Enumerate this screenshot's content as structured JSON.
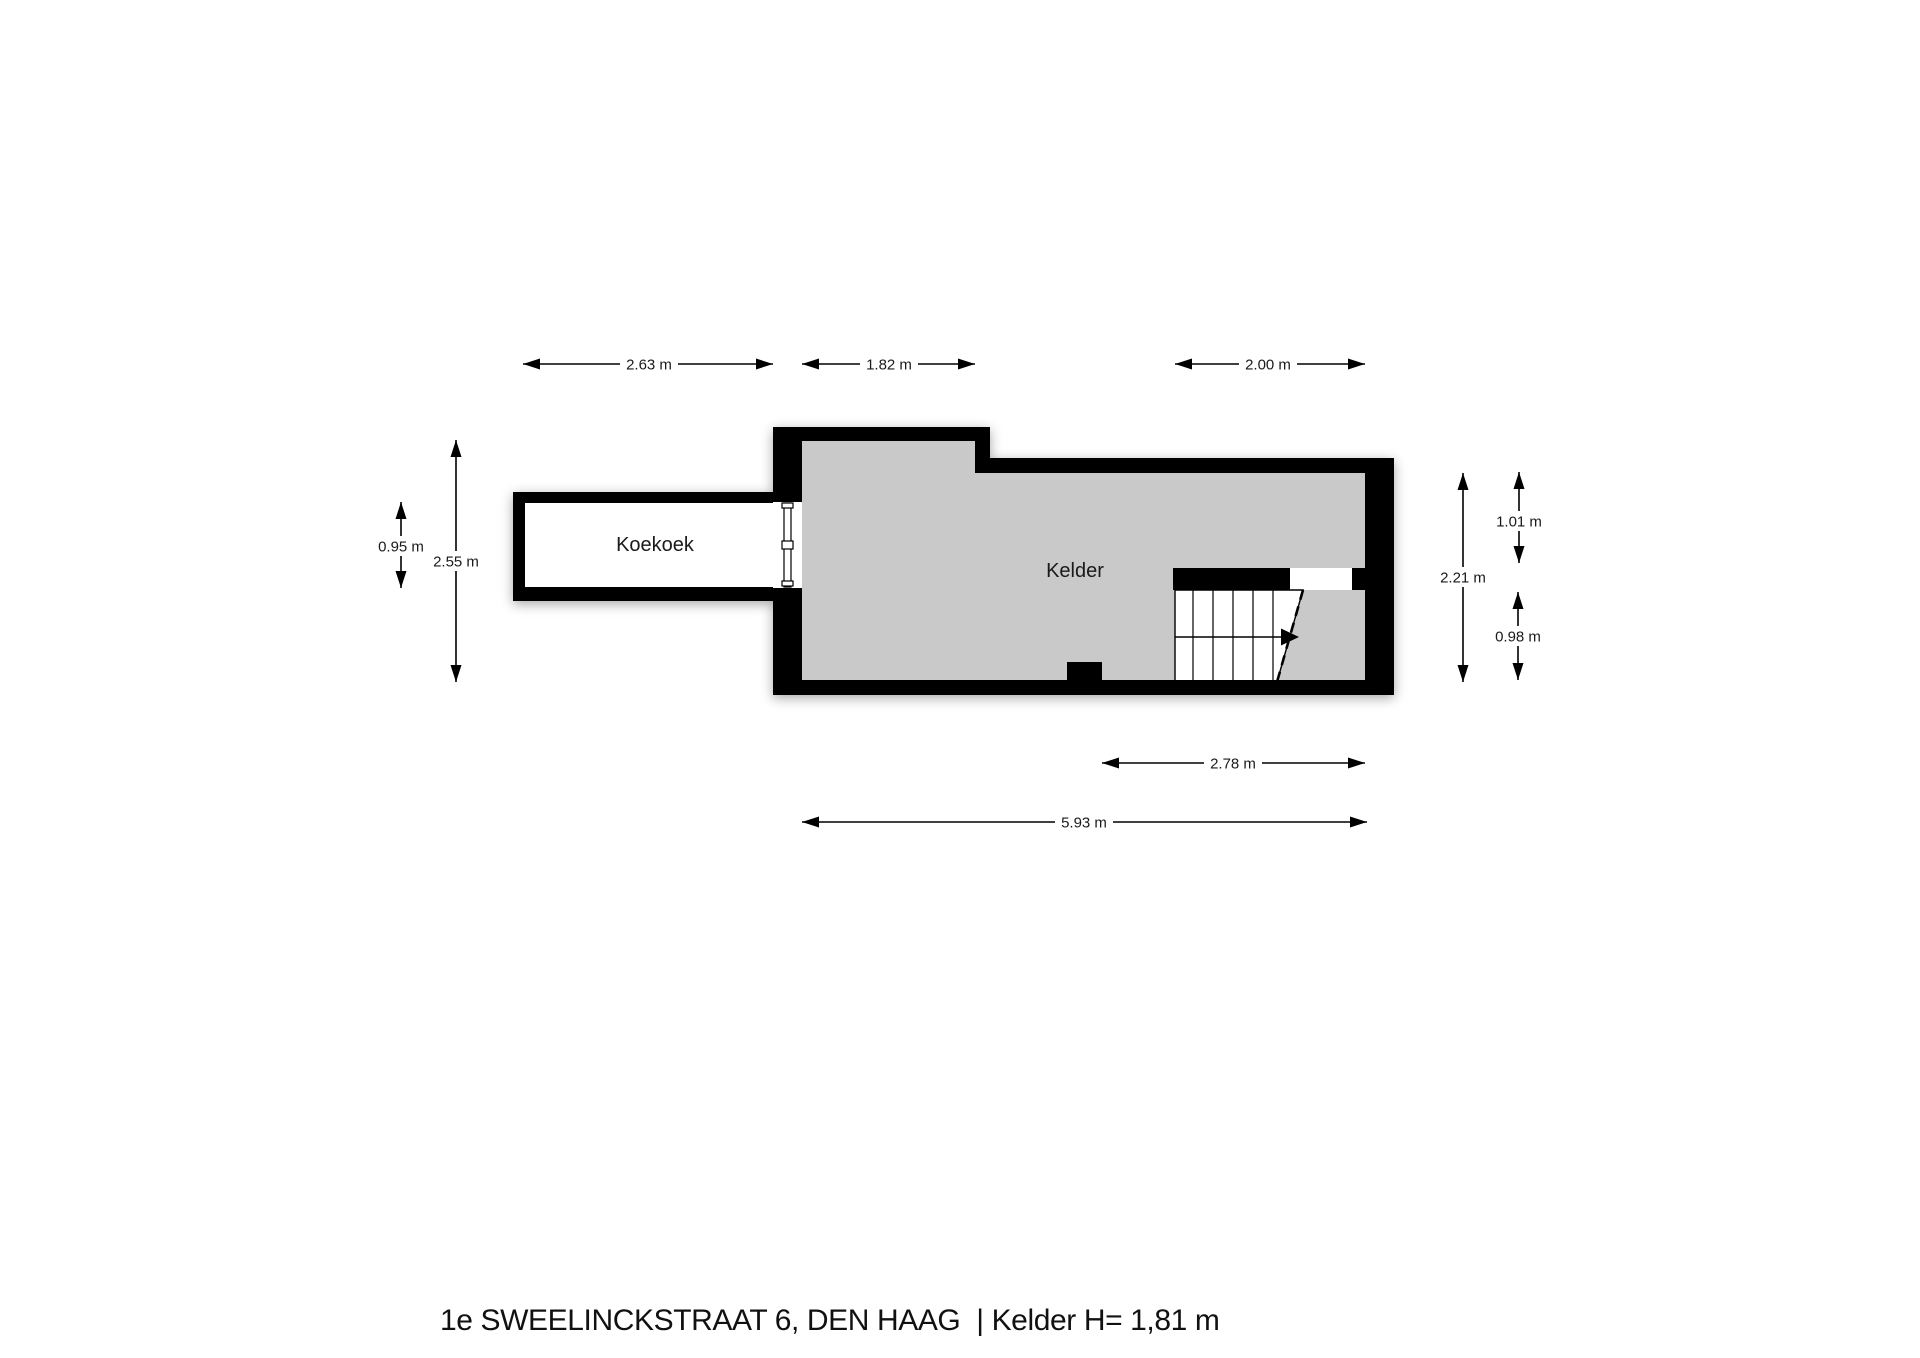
{
  "page": {
    "title": "1e SWEELINCKSTRAAT 6, DEN HAAG  | Kelder H= 1,81 m"
  },
  "floor_plan": {
    "rooms": [
      {
        "name": "Koekoek"
      },
      {
        "name": "Kelder"
      }
    ],
    "dimensions": {
      "top": [
        "2.63 m",
        "1.82 m",
        "2.00 m"
      ],
      "left": [
        "0.95 m",
        "2.55 m"
      ],
      "right": [
        "2.21 m",
        "1.01 m",
        "0.98 m"
      ],
      "bottom": [
        "2.78 m",
        "5.93 m"
      ]
    },
    "colors": {
      "wall": "#000000",
      "floor": "#c9c9c9",
      "koekoek_floor": "#ffffff",
      "background": "#ffffff",
      "text": "#1a1a1a"
    }
  }
}
